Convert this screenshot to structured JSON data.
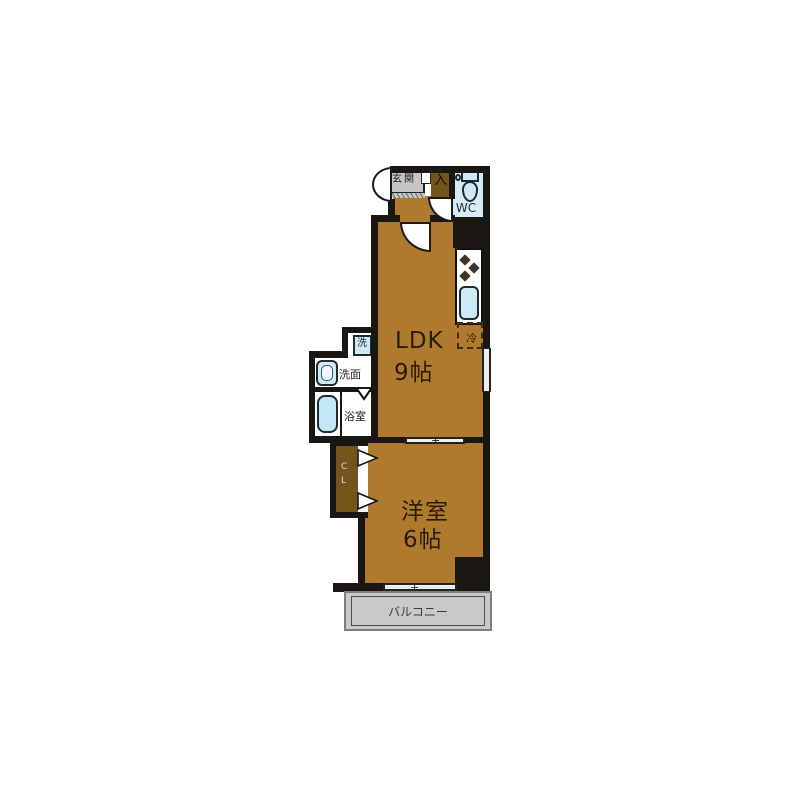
{
  "colors": {
    "room_floor": "#b07a2e",
    "dark_wood": "#74541a",
    "wall_black": "#1a1713",
    "fixture_blue": "#cfeaf5",
    "wc_floor_blue": "#d3ecf7",
    "cabinet_gray": "#c6c5c4",
    "balcony_gray": "#c9c9c9",
    "background": "#ffffff"
  },
  "plan": {
    "entrance": {
      "cabinet_label": "玄関",
      "step_label": "入"
    },
    "wc": {
      "label": "WC"
    },
    "ldk": {
      "name": "LDK",
      "size": "9帖"
    },
    "kitchen": {
      "fridge_label": "冷"
    },
    "utility": {
      "washer_label": "洗",
      "washroom_label": "洗面",
      "bathroom_label": "浴室"
    },
    "closet": {
      "letters": [
        "C",
        "L"
      ]
    },
    "western_room": {
      "name": "洋室",
      "size": "6帖"
    },
    "balcony": {
      "label": "バルコニー"
    }
  }
}
